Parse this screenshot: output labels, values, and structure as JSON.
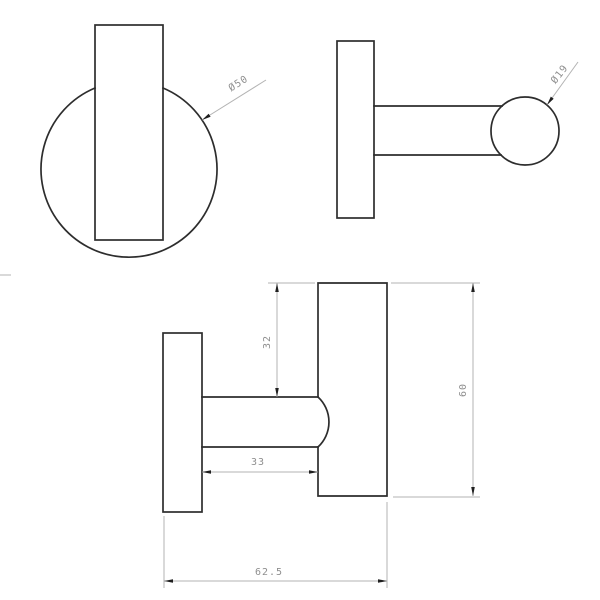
{
  "drawing": {
    "type": "technical-orthographic-views",
    "subject": "wall hook",
    "dimensions": {
      "front_plate_diameter": "Ø50",
      "knob_diameter": "Ø19",
      "hook_top_offset": "32",
      "inner_projection": "33",
      "hook_height": "60",
      "total_projection": "62.5"
    },
    "colors": {
      "background": "#ffffff",
      "geometry_line": "#2d2d2d",
      "dimension_line": "#b3b3b3",
      "dimension_text": "#8f8f8f",
      "arrowhead": "#1f1f1f"
    }
  }
}
